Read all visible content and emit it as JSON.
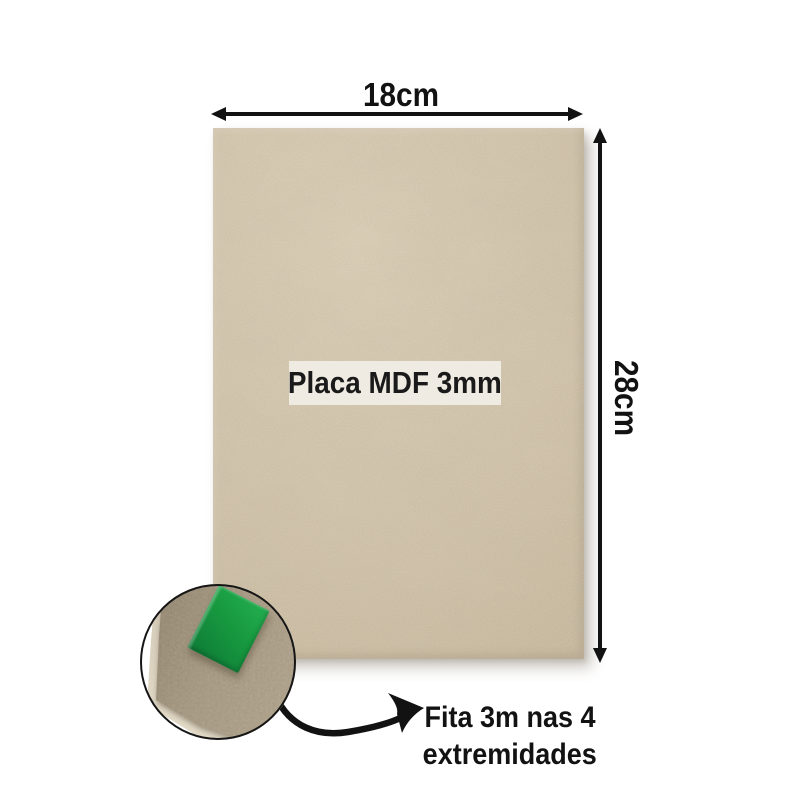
{
  "diagram": {
    "width_dimension_label": "18cm",
    "height_dimension_label": "28cm",
    "board_label": "Placa MDF 3mm",
    "tape_note_line1": "Fita 3m nas 4",
    "tape_note_line2": "extremidades"
  },
  "icons": {
    "width_arrow": "double-headed-horizontal-arrow",
    "height_arrow": "double-headed-vertical-arrow",
    "callout_arrow": "curved-hand-drawn-arrow",
    "zoom_lens": "corner-magnifier-circle"
  },
  "colors": {
    "ink": "#121212",
    "board_base": "#d1c2a8",
    "board_light": "#dbceb5",
    "board_dark": "#c2b396",
    "label_strip_bg": "rgba(242,240,233,0.88)",
    "label_text": "#1a1a1a",
    "zoom_mdf_base": "#a3957e",
    "zoom_mdf_dark": "#8d806a",
    "zoom_mdf_light": "#ac9e87",
    "mdf_cut_edge": "#d9d0bd",
    "tape_green": "#17993f",
    "tape_green_light": "#21aa4d",
    "tape_green_dark": "#0f7e38"
  }
}
